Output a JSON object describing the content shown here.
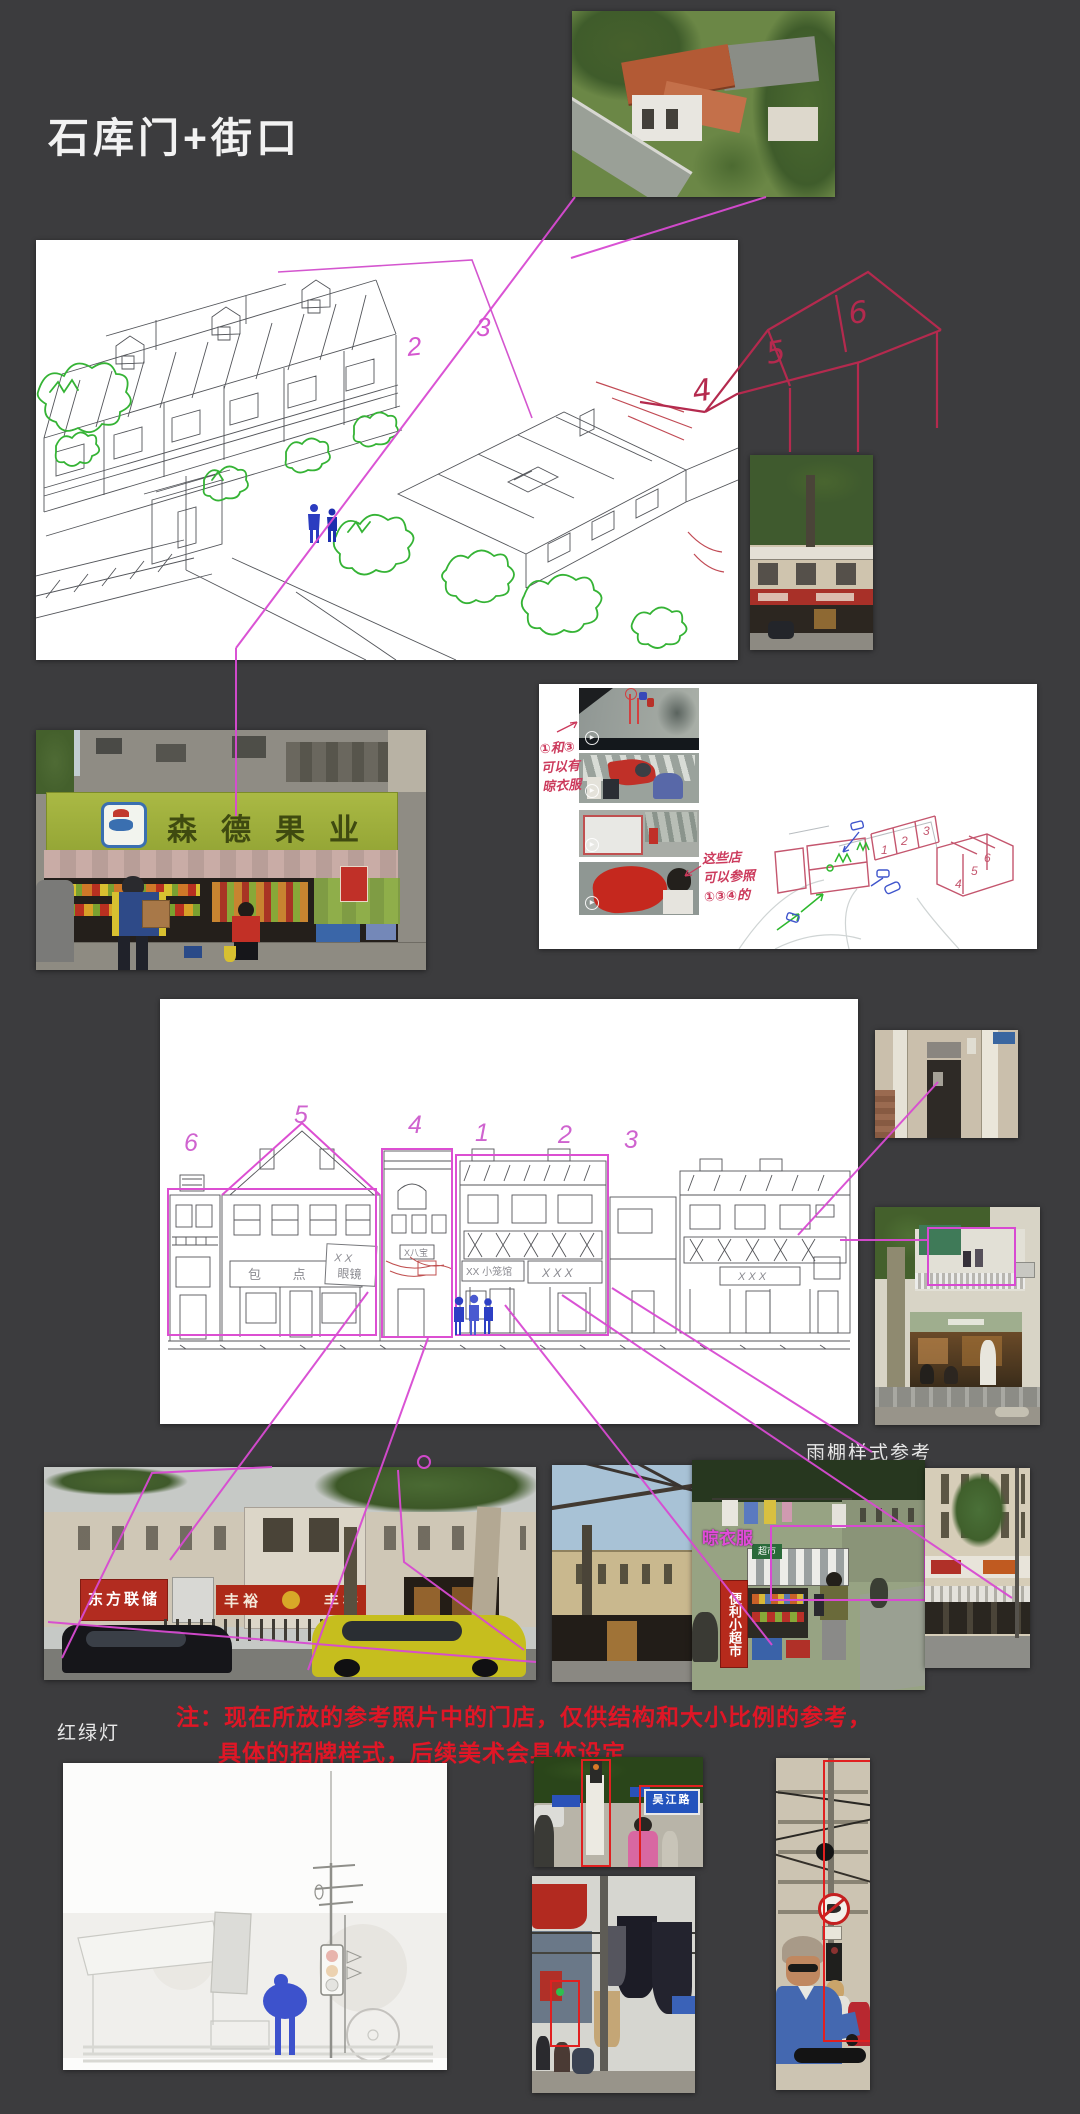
{
  "title": "石库门+街口",
  "icons": {
    "play": "▶"
  },
  "note": {
    "line1": "注：现在所放的参考照片中的门店，仅供结构和大小比例的参考，",
    "line2": "具体的招牌样式，后续美术会具体设定"
  },
  "captions": {
    "awning_ref": "雨棚样式参考",
    "traffic_light": "红绿灯",
    "drying": "晾衣服"
  },
  "main_sketch": {
    "n2": "2",
    "n3": "3",
    "n4": "4",
    "n5": "5",
    "n6": "6"
  },
  "storyboard": {
    "note_left": [
      "①和③",
      "可以有",
      "晾衣服"
    ],
    "note_right": [
      "这些店",
      "可以参照",
      "①③④的"
    ],
    "n1": "1",
    "n2": "2",
    "n3": "3",
    "n4": "4",
    "n5": "5",
    "n6": "6"
  },
  "elevation": {
    "n6": "6",
    "n5": "5",
    "n4": "4",
    "n1": "1",
    "n2": "2",
    "n3": "3",
    "signs": {
      "bakery": "包 点 铺",
      "glasses_top": "X X",
      "glasses_bottom": "眼镜",
      "small_sign": "X八宝",
      "noodle": "XX 小笼馆",
      "xxx": "X X X",
      "xxx2": "X X X"
    }
  },
  "photos": {
    "fruit_sign": "森德果业",
    "dongfang": "东方联储",
    "fengyu_left": "丰 裕",
    "fengyu_right": "丰 裕",
    "convenience_vertical": "便利小超市",
    "awning_mini": "超市",
    "street_name": "吴江路"
  },
  "colors": {
    "background": "#3c3c3e",
    "magenta_annotation": "#d84ad2",
    "red_annotation": "#b42a4e",
    "note_red": "#e01626",
    "sketch_green": "#35b335",
    "figure_blue": "#2b3cc0"
  }
}
